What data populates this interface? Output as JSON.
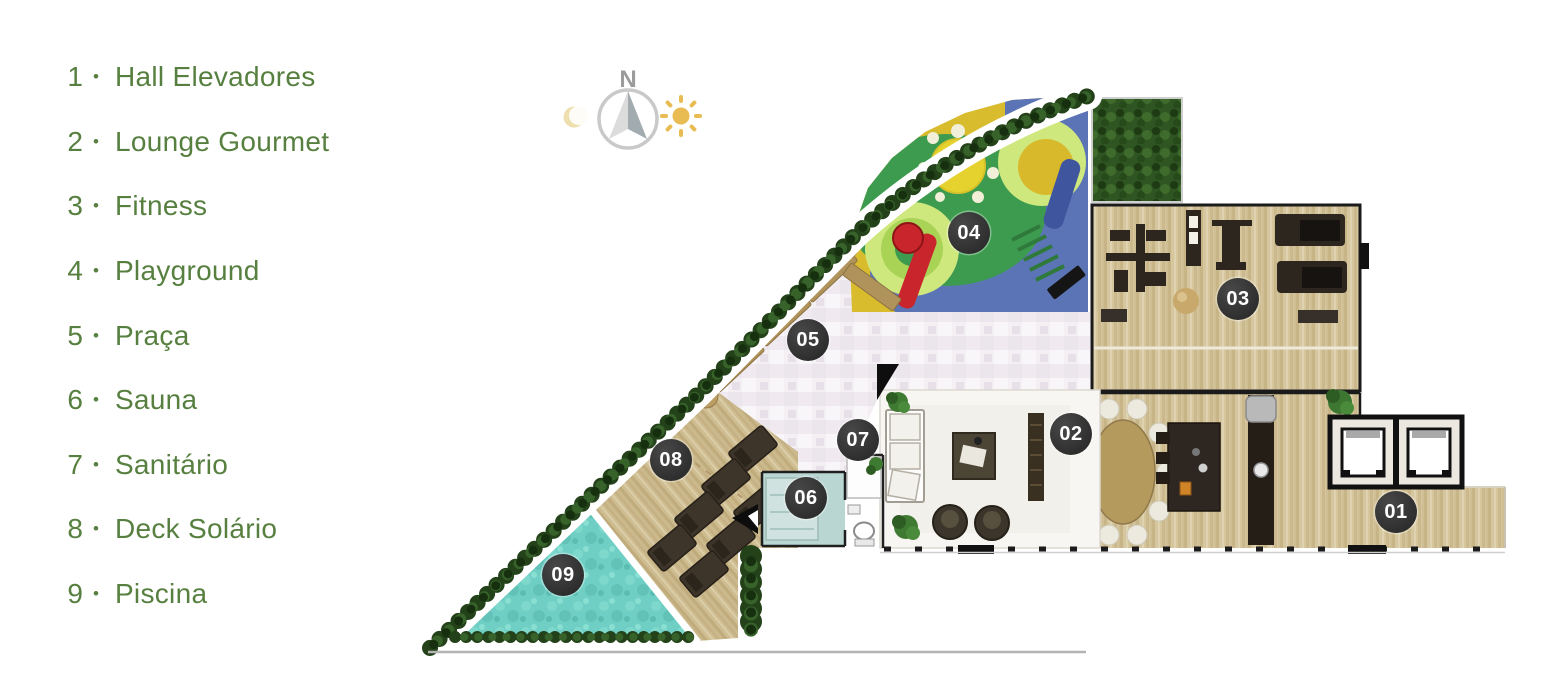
{
  "legend": {
    "items": [
      {
        "number": "1",
        "separator": "•",
        "label": "Hall Elevadores"
      },
      {
        "number": "2",
        "separator": "•",
        "label": "Lounge Gourmet"
      },
      {
        "number": "3",
        "separator": "•",
        "label": "Fitness"
      },
      {
        "number": "4",
        "separator": "•",
        "label": "Playground"
      },
      {
        "number": "5",
        "separator": "•",
        "label": "Praça"
      },
      {
        "number": "6",
        "separator": "•",
        "label": "Sauna"
      },
      {
        "number": "7",
        "separator": "•",
        "label": "Sanitário"
      },
      {
        "number": "8",
        "separator": "•",
        "label": "Deck Solário"
      },
      {
        "number": "9",
        "separator": "•",
        "label": "Piscina"
      }
    ]
  },
  "compass": {
    "north_label": "N"
  },
  "floorplan": {
    "markers": [
      {
        "id": "01",
        "area": "hall-elevadores"
      },
      {
        "id": "02",
        "area": "lounge-gourmet"
      },
      {
        "id": "03",
        "area": "fitness"
      },
      {
        "id": "04",
        "area": "playground"
      },
      {
        "id": "05",
        "area": "praca"
      },
      {
        "id": "06",
        "area": "sauna"
      },
      {
        "id": "07",
        "area": "sanitario"
      },
      {
        "id": "08",
        "area": "deck-solario"
      },
      {
        "id": "09",
        "area": "piscina"
      }
    ]
  },
  "colors": {
    "legend_text": "#578040",
    "marker_bg": "#2d2d2d",
    "marker_text": "#ffffff",
    "pool_water": "#70cfc4",
    "wood_floor": "#d6c69e",
    "hedge_green": "#2f5523",
    "playground_yellow": "#d9bc2e",
    "playground_green": "#3d9b4f",
    "playground_blue": "#5b74b5",
    "slide_red": "#c8252c",
    "sun_gold": "#e8bc52"
  }
}
